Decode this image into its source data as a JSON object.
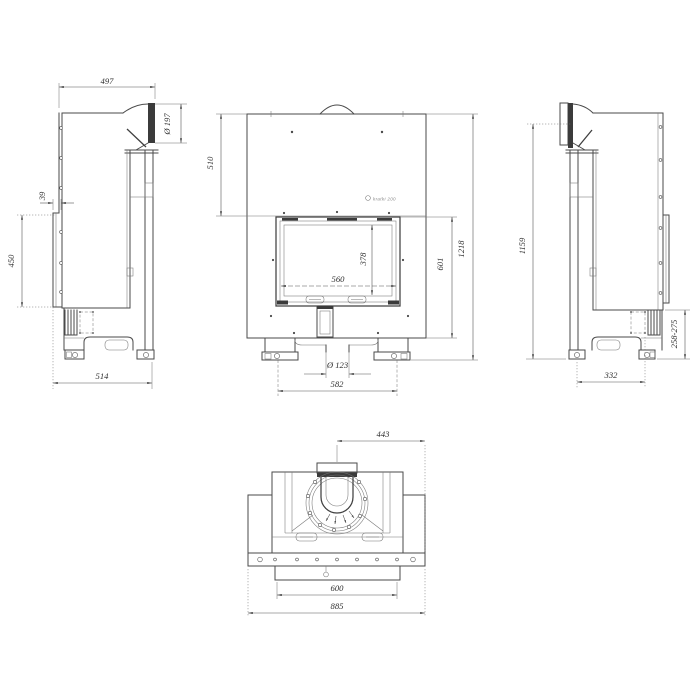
{
  "views": {
    "left_side": {
      "dims": {
        "top_depth": "497",
        "flue_diameter": "Ø 197",
        "door_offset": "39",
        "door_height": "450",
        "base_depth": "514"
      }
    },
    "front": {
      "brand_mark": "kratki 200",
      "dims": {
        "top_section_height": "510",
        "glass_width": "560",
        "glass_height": "378",
        "lower_section_height": "601",
        "total_height": "1218",
        "air_inlet_diameter": "Ø 123",
        "feet_spacing": "582"
      }
    },
    "right_side": {
      "dims": {
        "flue_axis_height": "1159",
        "rear_height_range": "258-275",
        "feet_spacing": "332"
      }
    },
    "top": {
      "dims": {
        "flue_center_to_front": "443",
        "base_plate_width": "600",
        "overall_width": "885"
      }
    }
  }
}
